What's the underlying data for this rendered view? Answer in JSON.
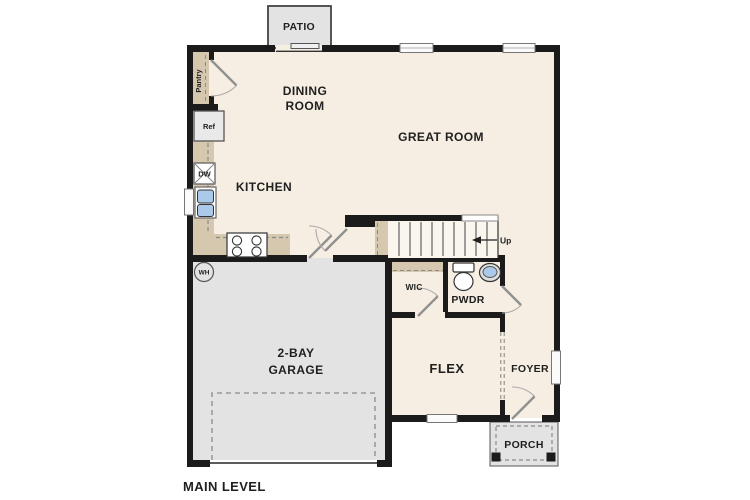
{
  "title": "MAIN LEVEL",
  "colors": {
    "wall": "#1b1b1b",
    "floor": "#f6eee2",
    "tan": "#d6c7af",
    "gray": "#e3e3e3",
    "blue": "#abc9e9",
    "dash": "#8a8a8a",
    "ink": "#1f1f1f",
    "line": "#999999"
  },
  "rooms": {
    "patio": "PATIO",
    "dining_line1": "DINING",
    "dining_line2": "ROOM",
    "great_room": "GREAT ROOM",
    "kitchen": "KITCHEN",
    "garage_line1": "2-BAY",
    "garage_line2": "GARAGE",
    "wic": "WIC",
    "pwdr": "PWDR",
    "flex": "FLEX",
    "foyer": "FOYER",
    "porch": "PORCH"
  },
  "fixtures": {
    "pantry": "Pantry",
    "ref": "Ref",
    "dw": "DW",
    "wh": "WH",
    "up": "Up"
  }
}
